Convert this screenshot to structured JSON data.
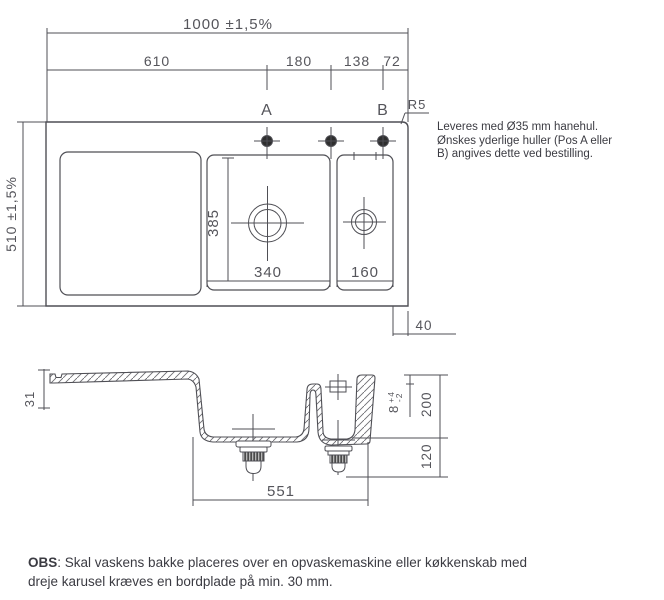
{
  "colors": {
    "line": "#4f4f55",
    "dim_text": "#55555b",
    "note_text": "#3b3b42",
    "hole_fill": "#2e2e2e"
  },
  "top_view": {
    "dims": {
      "total_width": "1000 ±1,5%",
      "seg_610": "610",
      "seg_180": "180",
      "seg_138": "138",
      "seg_72": "72",
      "total_depth": "510 ±1,5%",
      "bowl_depth": "385",
      "bowl_width": "340",
      "small_bowl_width": "160",
      "edge_offset": "40",
      "pos_a": "A",
      "pos_b": "B",
      "corner_radius": "R5"
    }
  },
  "section_view": {
    "dims": {
      "front_height": "31",
      "rim_height": "8",
      "rim_tol_plus": "+4",
      "rim_tol_minus": "-2",
      "total_depth": "200",
      "drain_depth": "120",
      "bowl_span": "551"
    }
  },
  "note": {
    "lines": [
      "Leveres med Ø35 mm hanehul.",
      "Ønskes yderlige huller (Pos A eller",
      "B) angives dette ved bestilling."
    ]
  },
  "obs": {
    "label": "OBS",
    "body": ": Skal vaskens bakke placeres over en opvaskemaskine eller køkkenskab med dreje karusel kræves en bordplade på min. 30 mm."
  }
}
